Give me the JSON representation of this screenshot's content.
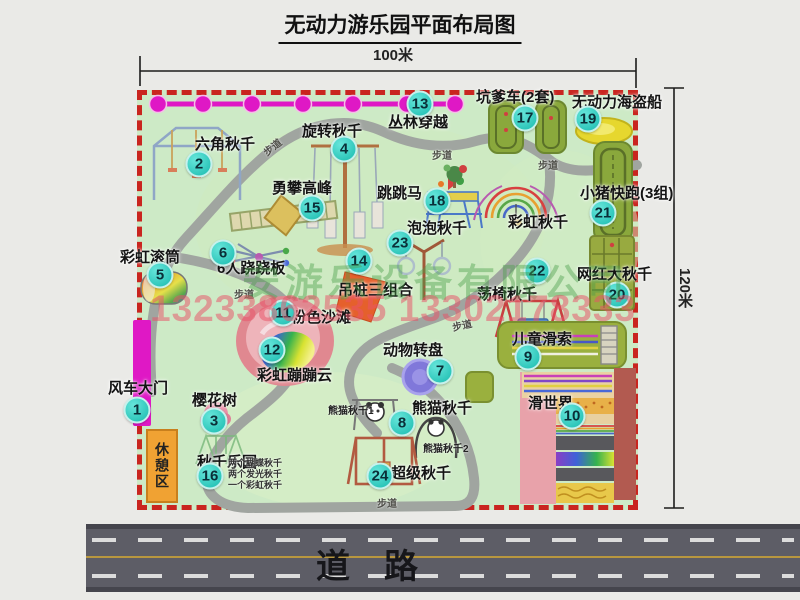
{
  "title": "无动力游乐园平面布局图",
  "dimensions": {
    "width": "100米",
    "height": "120米"
  },
  "road": {
    "label": "道路"
  },
  "watermark": {
    "company": "安游乐设备有限公司",
    "phones": "13233862535 13302178333"
  },
  "rest_area": {
    "label": "休憩区"
  },
  "attractions": [
    {
      "num": 1,
      "name": "风车大门",
      "cx": 137,
      "cy": 410,
      "lx": 108,
      "ly": 381
    },
    {
      "num": 2,
      "name": "六角秋千",
      "cx": 199,
      "cy": 164,
      "lx": 195,
      "ly": 137
    },
    {
      "num": 3,
      "name": "樱花树",
      "cx": 214,
      "cy": 421,
      "lx": 192,
      "ly": 393
    },
    {
      "num": 4,
      "name": "旋转秋千",
      "cx": 344,
      "cy": 149,
      "lx": 302,
      "ly": 124
    },
    {
      "num": 5,
      "name": "彩虹滚筒",
      "cx": 160,
      "cy": 275,
      "lx": 120,
      "ly": 250
    },
    {
      "num": 6,
      "name": "6人跷跷板",
      "cx": 223,
      "cy": 253,
      "lx": 217,
      "ly": 261
    },
    {
      "num": 7,
      "name": "动物转盘",
      "cx": 440,
      "cy": 371,
      "lx": 383,
      "ly": 343
    },
    {
      "num": 8,
      "name": "熊猫秋千",
      "cx": 402,
      "cy": 423,
      "lx": 412,
      "ly": 401
    },
    {
      "num": 9,
      "name": "儿童滑索",
      "cx": 528,
      "cy": 357,
      "lx": 512,
      "ly": 332
    },
    {
      "num": 10,
      "name": "滑世界",
      "cx": 572,
      "cy": 416,
      "lx": 528,
      "ly": 396
    },
    {
      "num": 11,
      "name": "粉色沙滩",
      "cx": 283,
      "cy": 313,
      "lx": 291,
      "ly": 310
    },
    {
      "num": 12,
      "name": "彩虹蹦蹦云",
      "cx": 272,
      "cy": 350,
      "lx": 257,
      "ly": 368
    },
    {
      "num": 13,
      "name": "丛林穿越",
      "cx": 420,
      "cy": 104,
      "lx": 388,
      "ly": 115
    },
    {
      "num": 14,
      "name": "吊桩三组合",
      "cx": 359,
      "cy": 261,
      "lx": 338,
      "ly": 283
    },
    {
      "num": 15,
      "name": "勇攀高峰",
      "cx": 312,
      "cy": 208,
      "lx": 272,
      "ly": 181
    },
    {
      "num": 16,
      "name": "秋千乐园",
      "cx": 210,
      "cy": 476,
      "lx": 197,
      "ly": 455
    },
    {
      "num": 17,
      "name": "坑爹车(2套)",
      "cx": 525,
      "cy": 118,
      "lx": 476,
      "ly": 90
    },
    {
      "num": 18,
      "name": "跳跳马",
      "cx": 437,
      "cy": 201,
      "lx": 377,
      "ly": 186
    },
    {
      "num": 19,
      "name": "无动力海盗船",
      "cx": 588,
      "cy": 119,
      "lx": 572,
      "ly": 95
    },
    {
      "num": 20,
      "name": "网红大秋千",
      "cx": 617,
      "cy": 295,
      "lx": 577,
      "ly": 267
    },
    {
      "num": 21,
      "name": "小猪快跑(3组)",
      "cx": 603,
      "cy": 213,
      "lx": 580,
      "ly": 186
    },
    {
      "num": 22,
      "name": "荡椅秋千",
      "cx": 537,
      "cy": 271,
      "lx": 477,
      "ly": 287
    },
    {
      "num": 23,
      "name": "泡泡秋千",
      "cx": 400,
      "cy": 243,
      "lx": 407,
      "ly": 221
    },
    {
      "num": 24,
      "name": "超级秋千",
      "cx": 380,
      "cy": 476,
      "lx": 391,
      "ly": 466
    },
    {
      "num": null,
      "name": "彩虹秋千",
      "cx": null,
      "cy": null,
      "lx": 508,
      "ly": 215
    }
  ],
  "path_labels": [
    {
      "text": "步道",
      "x": 262,
      "y": 139,
      "rot": -38
    },
    {
      "text": "步道",
      "x": 432,
      "y": 147,
      "rot": 0
    },
    {
      "text": "步道",
      "x": 538,
      "y": 157,
      "rot": 0
    },
    {
      "text": "步道",
      "x": 234,
      "y": 286,
      "rot": 0
    },
    {
      "text": "步道",
      "x": 452,
      "y": 317,
      "rot": -12
    },
    {
      "text": "步道",
      "x": 377,
      "y": 495,
      "rot": 0
    }
  ],
  "small_labels": [
    {
      "text": "熊猫秋千1",
      "x": 328,
      "y": 402
    },
    {
      "text": "熊猫秋千2",
      "x": 423,
      "y": 440
    }
  ],
  "swing_park_notes": {
    "x": 228,
    "y": 458,
    "lines": [
      "两个蝴蝶秋千",
      "两个发光秋千",
      "一个彩虹秋千"
    ]
  },
  "colors": {
    "map_bg": "#cdeac6",
    "border_red": "#c9251f",
    "walkway_gray": "#a0a5a0",
    "marker_teal": "#2cc5b9",
    "gate_magenta": "#df18c5",
    "road_gray": "#5d5d66",
    "rest_orange": "#f0a233"
  }
}
